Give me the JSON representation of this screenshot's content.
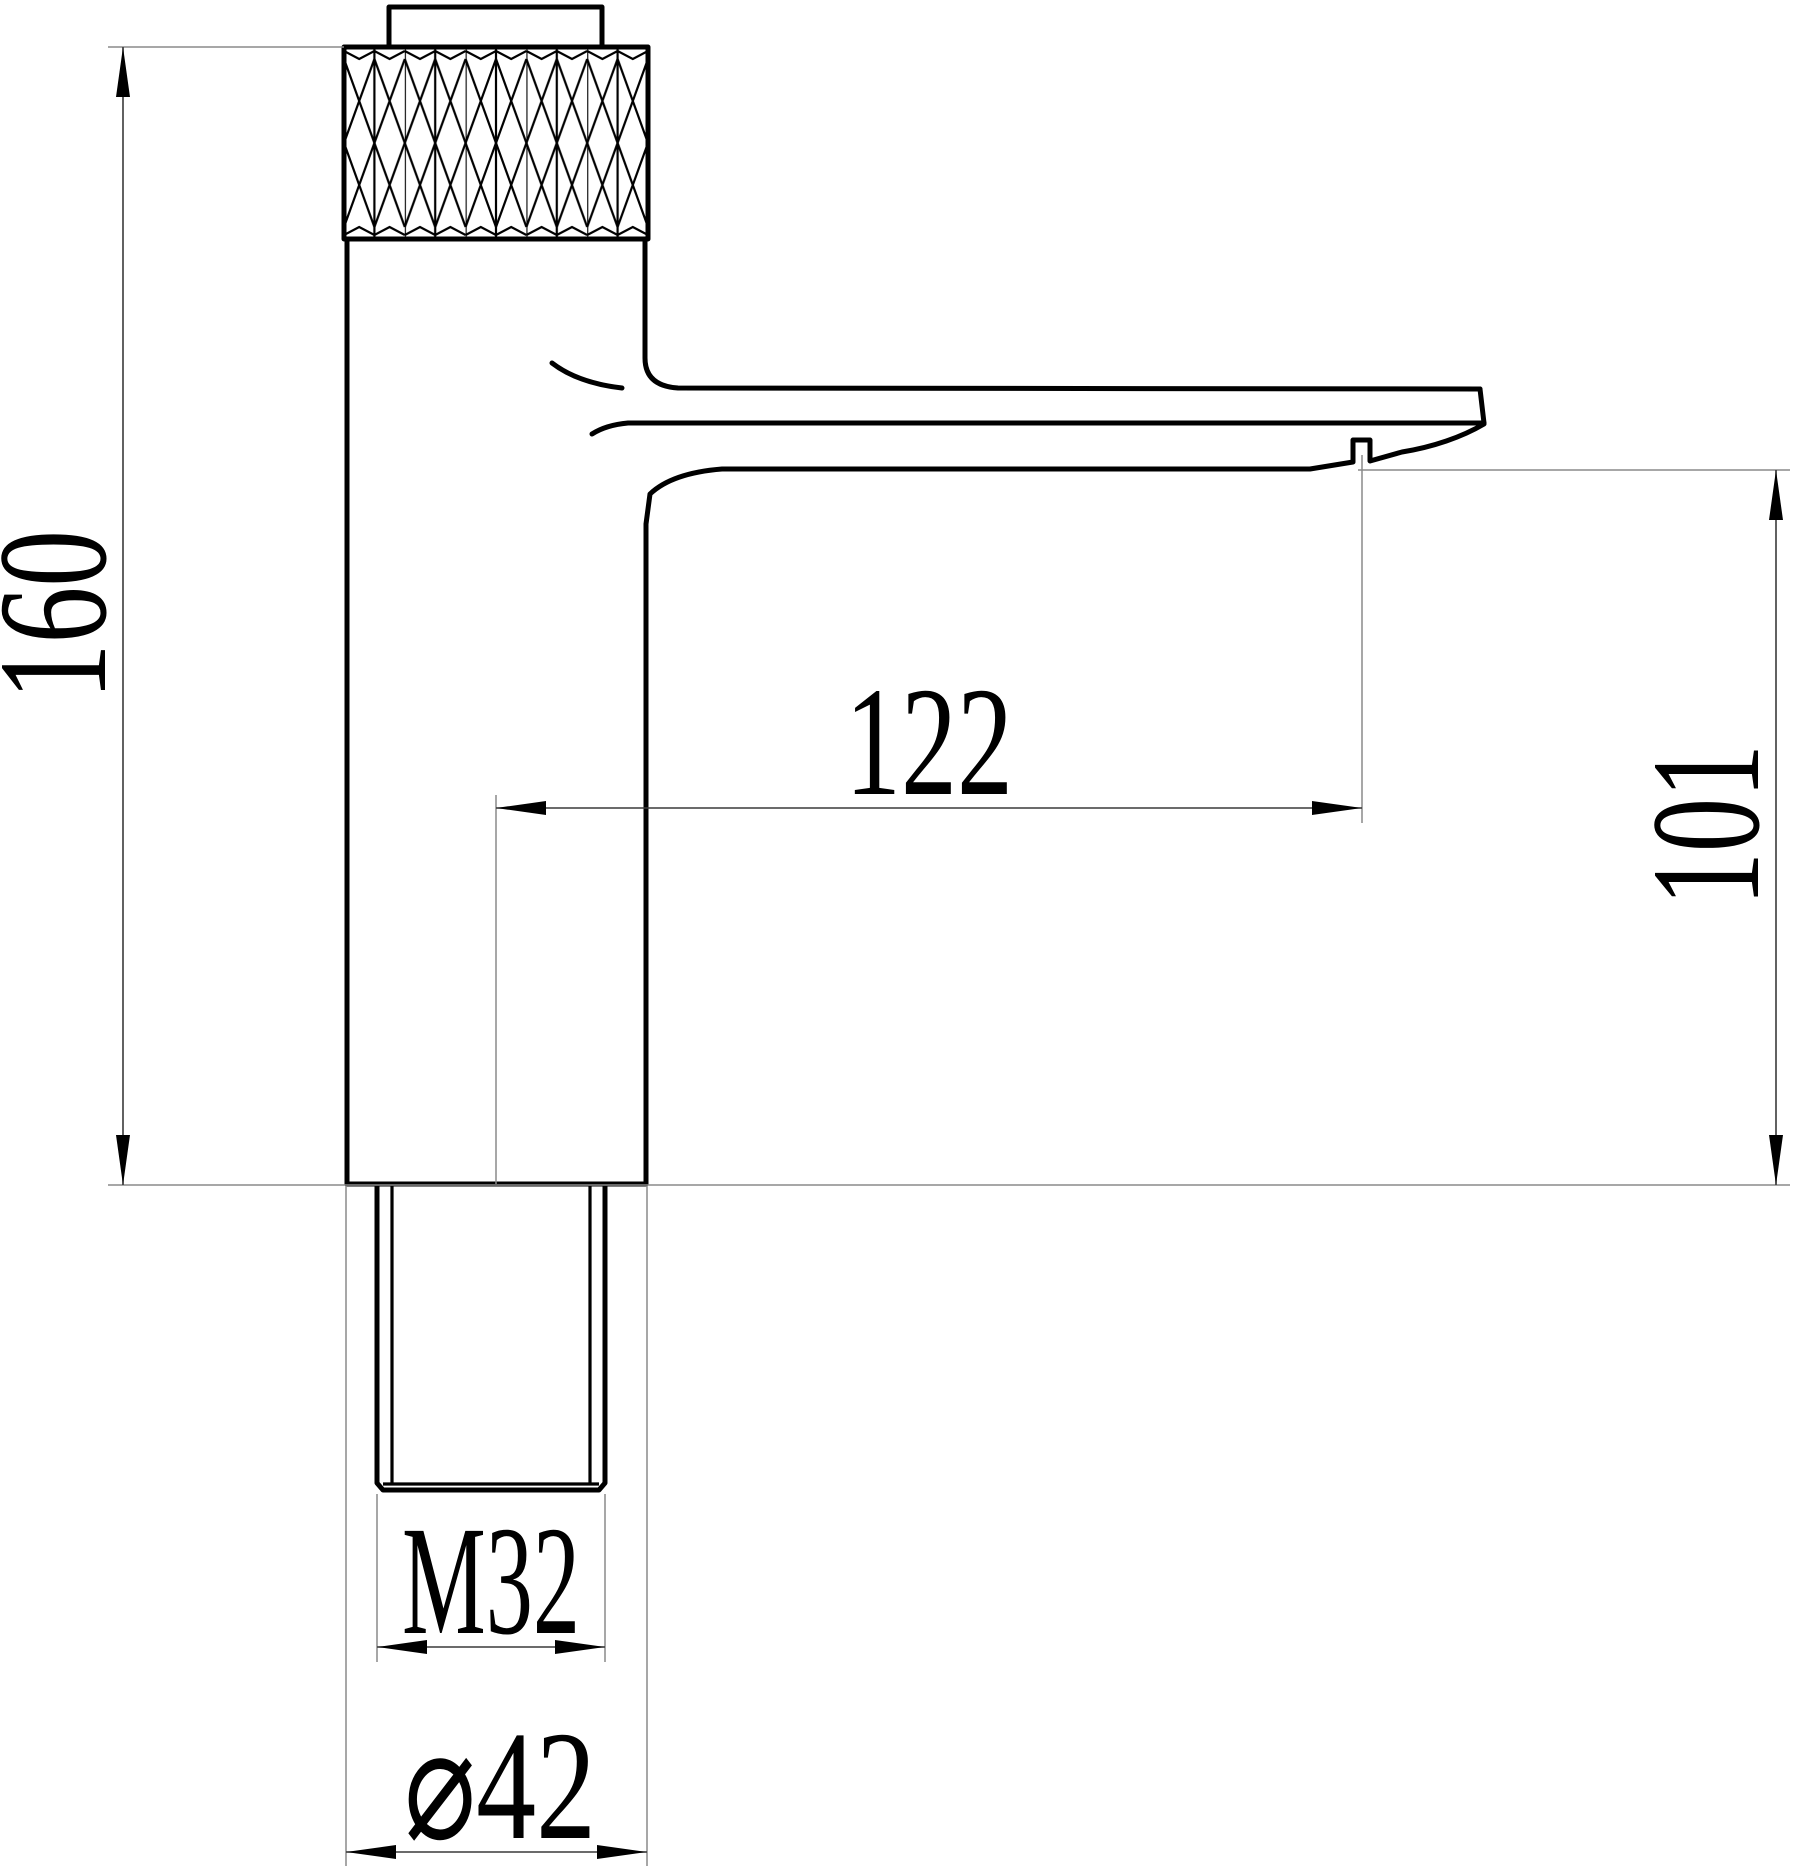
{
  "drawing": {
    "type": "technical-dimension-drawing",
    "subject": "basin faucet side elevation",
    "background_color": "#ffffff",
    "outline_color": "#000000",
    "dimension_line_color": "#3a3a3a",
    "extension_line_color": "#8a8a8a",
    "dimensions": {
      "overall_height": {
        "label": "160",
        "orientation": "vertical",
        "side": "left"
      },
      "spout_reach": {
        "label": "122",
        "orientation": "horizontal",
        "side": "middle"
      },
      "spout_outlet_height": {
        "label": "101",
        "orientation": "vertical",
        "side": "right"
      },
      "thread_size": {
        "label": "M32",
        "orientation": "horizontal",
        "side": "bottom"
      },
      "body_diameter": {
        "label": "⌀42",
        "orientation": "horizontal",
        "side": "bottom"
      }
    },
    "features": {
      "top_cap": "cap on knurled handle",
      "knurl_band": "knurled grip band",
      "body": "cylindrical faucet body",
      "spout": "flat horizontal spout with aerator notch",
      "shank": "M32 threaded mounting shank"
    }
  }
}
